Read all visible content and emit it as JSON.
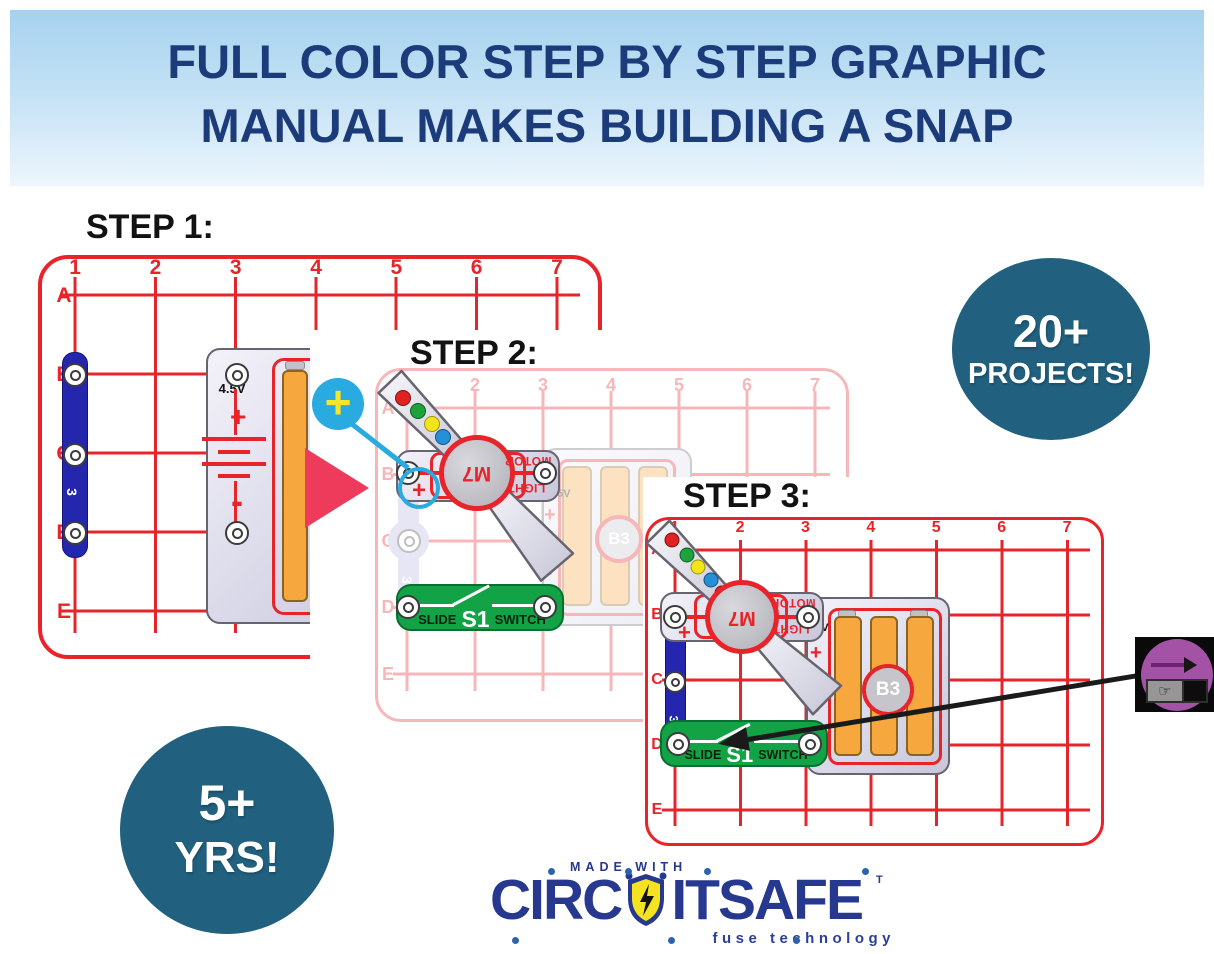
{
  "header": {
    "line1": "FULL COLOR STEP BY STEP GRAPHIC",
    "line2": "MANUAL MAKES BUILDING A SNAP"
  },
  "steps": [
    {
      "title": "STEP 1:",
      "cols": [
        "1",
        "2",
        "3",
        "4",
        "5",
        "6",
        "7"
      ],
      "rows": [
        "A",
        "B",
        "C",
        "D",
        "E"
      ]
    },
    {
      "title": "STEP 2:",
      "cols": [
        "1",
        "2",
        "3",
        "4",
        "5",
        "6",
        "7"
      ],
      "rows": [
        "A",
        "B",
        "C",
        "D",
        "E"
      ]
    },
    {
      "title": "STEP 3:",
      "cols": [
        "1",
        "2",
        "3",
        "4",
        "5",
        "6",
        "7"
      ],
      "rows": [
        "A",
        "B",
        "C",
        "D",
        "E"
      ]
    }
  ],
  "parts": {
    "snap_wire": {
      "id": "3"
    },
    "battery_pack": {
      "id": "B3",
      "voltage": "4.5V",
      "plus": "+",
      "minus": "-"
    },
    "motor": {
      "id": "M7",
      "label_top": "MOTOR",
      "label_bottom": "LIGHT",
      "plus": "+"
    },
    "slide_switch": {
      "word_left": "SLIDE",
      "id": "S1",
      "word_right": "SWITCH"
    }
  },
  "annotations": {
    "plus_callout": "+"
  },
  "badges": {
    "projects": {
      "value": "20+",
      "label": "PROJECTS!"
    },
    "age": {
      "value": "5+",
      "label": "YRS!"
    }
  },
  "logo": {
    "made_with": "MADE WITH",
    "brand_left": "CIRC",
    "brand_right": "ITSAFE",
    "trademark": "T",
    "tagline": "fuse technology"
  },
  "icons": {
    "slide_hand": "☞"
  },
  "colors": {
    "board_red": "#e8242b",
    "badge_teal": "#21617f",
    "headline_navy": "#1c3b7a",
    "switch_green": "#13a347",
    "wire_blue": "#2427ae",
    "battery_orange": "#f6a83f",
    "callout_cyan": "#29abe2",
    "logo_navy": "#27388f",
    "icon_purple": "#a352a6"
  }
}
